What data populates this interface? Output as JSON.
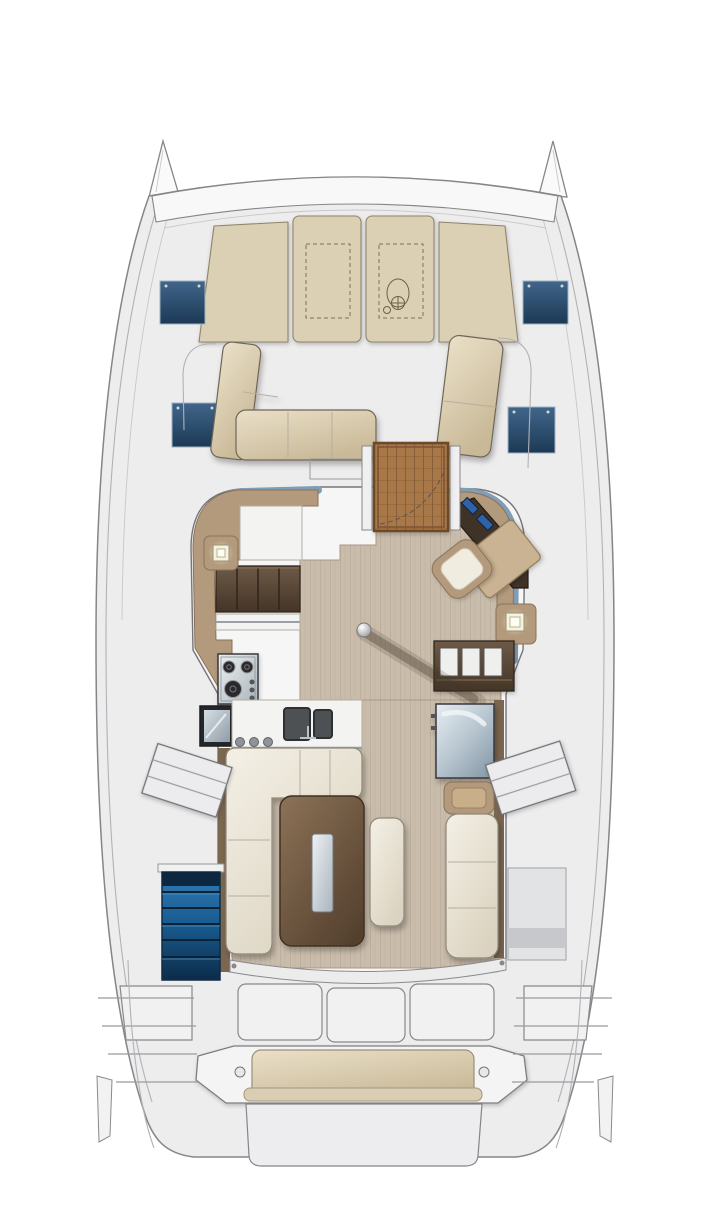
{
  "figure": {
    "type": "deck-plan",
    "subject": "catamaran interior and deck layout",
    "view": "top-down"
  },
  "palette": {
    "deck": "#ededee",
    "cabin": "#f6f6f6",
    "hull_outline": "#85858a",
    "sunpad": "#dcd0b4",
    "sunpad_edge": "#8f836b",
    "navy_hatch": "#2d4b68",
    "teak": "#a8784a",
    "teak_dark": "#7a5230",
    "wood_floor": "#c9bcab",
    "counter_tan": "#b39a7c",
    "counter_edge": "#8a7258",
    "locker_wood": "#5e4b3a",
    "sofa_cream": "#f1ede2",
    "sofa_edge": "#8e887a",
    "table_walnut": "#6e573f",
    "stairs_blue": "#1f6096",
    "window_steel": "#7f9db4",
    "steel_gray": "#aeb9c1",
    "glow": "#fff6c9"
  },
  "components": [
    "port-bow-tip",
    "starboard-bow-tip",
    "crossbeam",
    "foredeck-sunpads",
    "sunpad-hatch-outline",
    "windlass-sketch",
    "deck-hatch-forward-port",
    "deck-hatch-forward-starboard",
    "deck-hatch-mid-port",
    "deck-hatch-mid-starboard",
    "forward-cockpit-sofa-port",
    "forward-cockpit-bench-starboard",
    "forward-door-teak-grate",
    "door-swing-arc",
    "salon-cabin",
    "window-band-port",
    "window-band-starboard",
    "salon-floor",
    "galley-counter",
    "galley-lockers",
    "stove",
    "sink-counter",
    "double-sink",
    "port-hull-hatch",
    "port-hull-steps",
    "starboard-hull-steps",
    "nav-instrument-console",
    "nav-chart-table",
    "nav-seat",
    "reading-lamp-port",
    "reading-lamp-starboard",
    "storage-cabinet-starboard",
    "mast-post",
    "dinette-sofa",
    "dinette-table",
    "dinette-bench",
    "fridge",
    "drawer-unit",
    "salon-bench-starboard",
    "port-companionway-stairs",
    "aft-sliding-door",
    "aft-cockpit-lockers",
    "stern-bench",
    "stern-bench-cushion",
    "davit-platform",
    "transom-steps-port",
    "transom-steps-starboard"
  ]
}
